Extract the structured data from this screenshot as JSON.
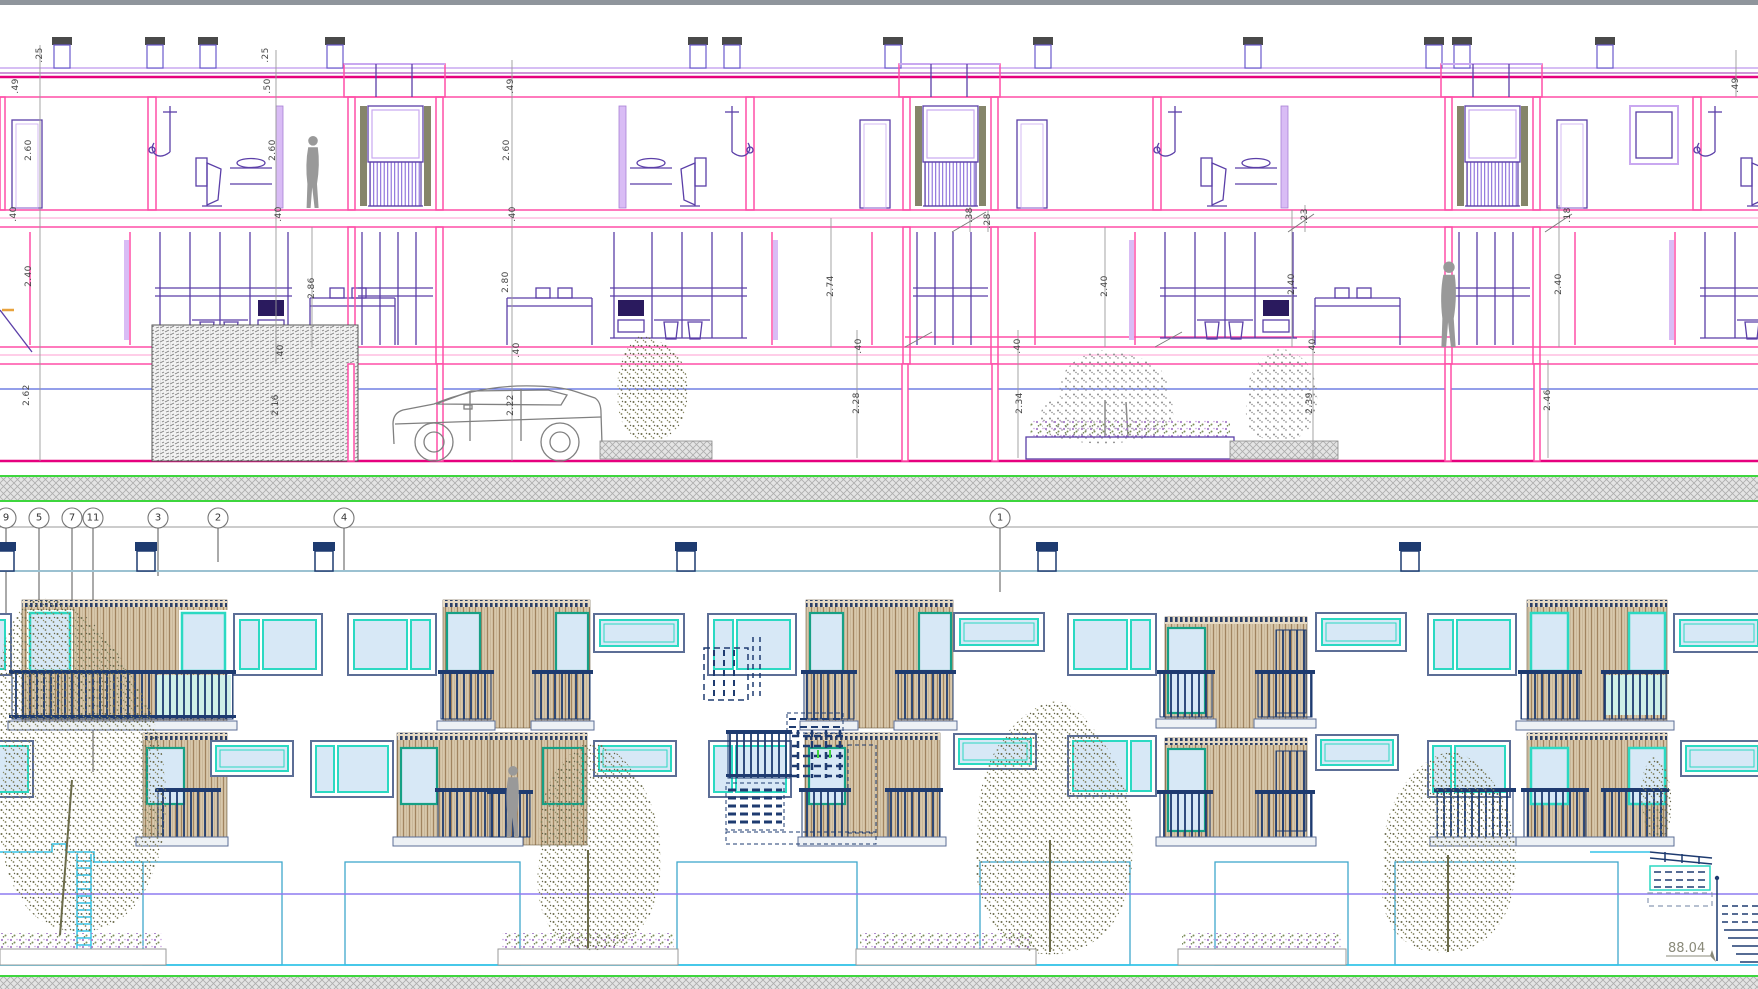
{
  "palette": {
    "section_wall_pink": "#FF4FA7",
    "section_wall_crimson": "#E6007E",
    "fixture_purple": "#5B3FA8",
    "lilac": "#C9A8F0",
    "top_bar_gray": "#8F959C",
    "ground_green": "#3ED63E",
    "datum_blue": "#5566DD",
    "elevation_navy": "#1E3B70",
    "window_outer_frame": "#5C6E96",
    "window_cyan": "#2BD9C2",
    "window_teal": "#16A085",
    "glass_blue": "#D7E8F6",
    "timber_tan": "#A18460",
    "roof_line_blue": "#9BC1D1",
    "datum_purple": "#8E7CF0",
    "ground_cyan": "#35C4E8",
    "foliage_olive": "#6E6E4E",
    "dim_text": "#444444",
    "level_text": "#8A8A7A"
  },
  "section_view": {
    "dimensions": [
      {
        "t": ".25",
        "x": 40,
        "y": 55
      },
      {
        "t": ".49",
        "x": 16,
        "y": 86
      },
      {
        "t": "2.60",
        "x": 29,
        "y": 150
      },
      {
        "t": ".40",
        "x": 14,
        "y": 214
      },
      {
        "t": "2.40",
        "x": 29,
        "y": 276
      },
      {
        "t": "2.62",
        "x": 27,
        "y": 395
      },
      {
        "t": ".25",
        "x": 266,
        "y": 55
      },
      {
        "t": ".50",
        "x": 268,
        "y": 86
      },
      {
        "t": "2.60",
        "x": 273,
        "y": 150
      },
      {
        "t": ".40",
        "x": 279,
        "y": 214
      },
      {
        "t": "2.86",
        "x": 312,
        "y": 288
      },
      {
        "t": ".40",
        "x": 281,
        "y": 352
      },
      {
        "t": "2.16",
        "x": 276,
        "y": 405
      },
      {
        "t": ".49",
        "x": 511,
        "y": 86
      },
      {
        "t": "2.60",
        "x": 507,
        "y": 150
      },
      {
        "t": ".40",
        "x": 513,
        "y": 214
      },
      {
        "t": "2.80",
        "x": 506,
        "y": 282
      },
      {
        "t": ".40",
        "x": 517,
        "y": 350
      },
      {
        "t": "2.22",
        "x": 511,
        "y": 405
      },
      {
        "t": "2.74",
        "x": 831,
        "y": 286
      },
      {
        "t": ".38",
        "x": 970,
        "y": 215
      },
      {
        "t": ".28",
        "x": 988,
        "y": 221
      },
      {
        "t": "2.40",
        "x": 1105,
        "y": 286
      },
      {
        "t": ".40",
        "x": 859,
        "y": 346
      },
      {
        "t": "2.28",
        "x": 857,
        "y": 403
      },
      {
        "t": ".40",
        "x": 1018,
        "y": 346
      },
      {
        "t": "2.34",
        "x": 1020,
        "y": 403
      },
      {
        "t": ".23",
        "x": 1305,
        "y": 216
      },
      {
        "t": "2.40",
        "x": 1292,
        "y": 284
      },
      {
        "t": ".40",
        "x": 1313,
        "y": 346
      },
      {
        "t": "2.39",
        "x": 1310,
        "y": 403
      },
      {
        "t": ".18",
        "x": 1568,
        "y": 215
      },
      {
        "t": "2.40",
        "x": 1559,
        "y": 284
      },
      {
        "t": "2.46",
        "x": 1548,
        "y": 400
      },
      {
        "t": ".49",
        "x": 1736,
        "y": 85
      }
    ]
  },
  "elevation_view": {
    "grid_bubbles": [
      {
        "label": "9",
        "x": 6
      },
      {
        "label": "5",
        "x": 39
      },
      {
        "label": "7",
        "x": 72
      },
      {
        "label": "11",
        "x": 93
      },
      {
        "label": "3",
        "x": 158
      },
      {
        "label": "2",
        "x": 218
      },
      {
        "label": "4",
        "x": 344
      },
      {
        "label": "1",
        "x": 1000
      }
    ],
    "level_marker": {
      "text": "88.04"
    }
  }
}
